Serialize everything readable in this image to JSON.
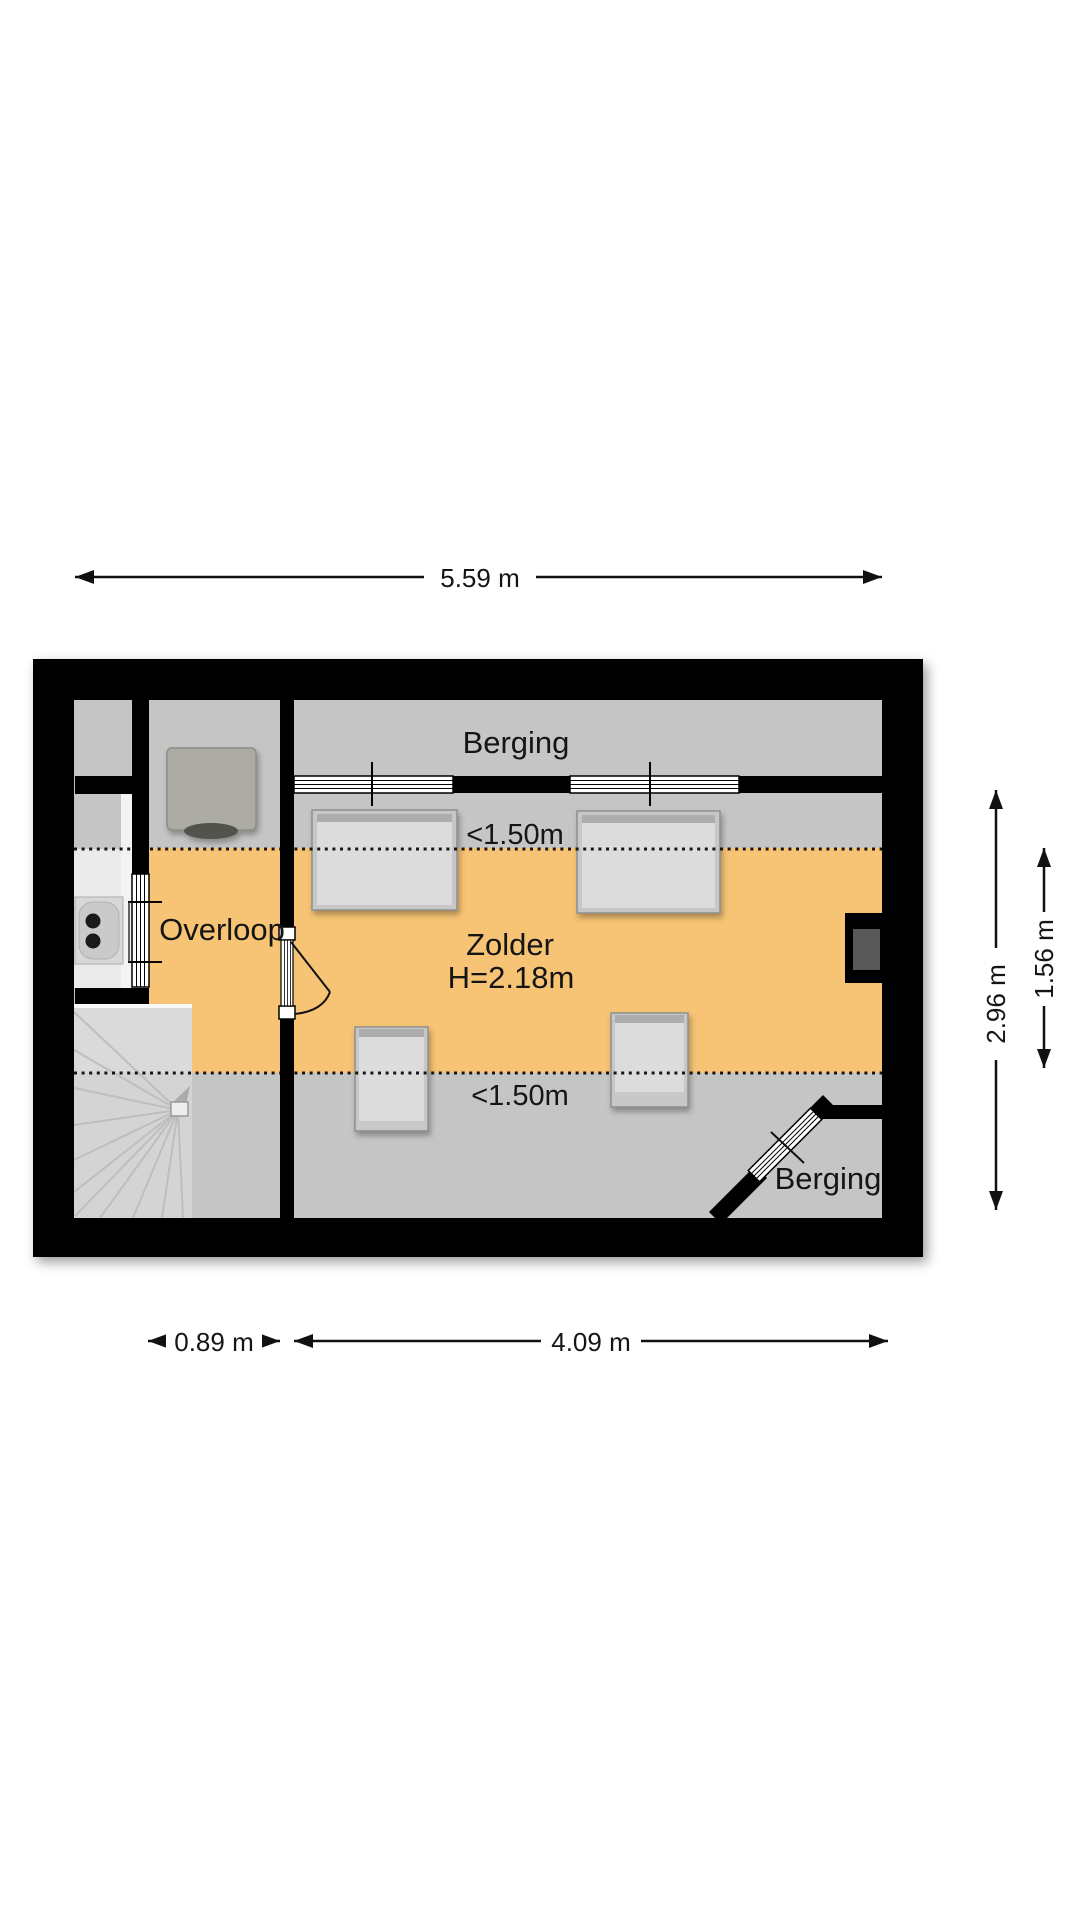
{
  "floorplan": {
    "rooms": {
      "berging_top": {
        "label": "Berging"
      },
      "overloop": {
        "label": "Overloop"
      },
      "zolder": {
        "label": "Zolder",
        "height_note": "H=2.18m"
      },
      "berging_bottom": {
        "label": "Berging"
      }
    },
    "low_ceiling_zones": {
      "top": "<1.50m",
      "bottom": "<1.50m"
    },
    "dimensions": {
      "total_width": "5.59 m",
      "overloop_width": "0.89 m",
      "zolder_width": "4.09 m",
      "total_depth": "2.96 m",
      "full_height_depth": "1.56 m"
    },
    "colors": {
      "full_height_zone": "#F6C474",
      "low_height_zone": "#C5C5C5",
      "wall": "#000000",
      "stairs": "#D4D4D4",
      "furniture": "#DCDCDC"
    }
  }
}
